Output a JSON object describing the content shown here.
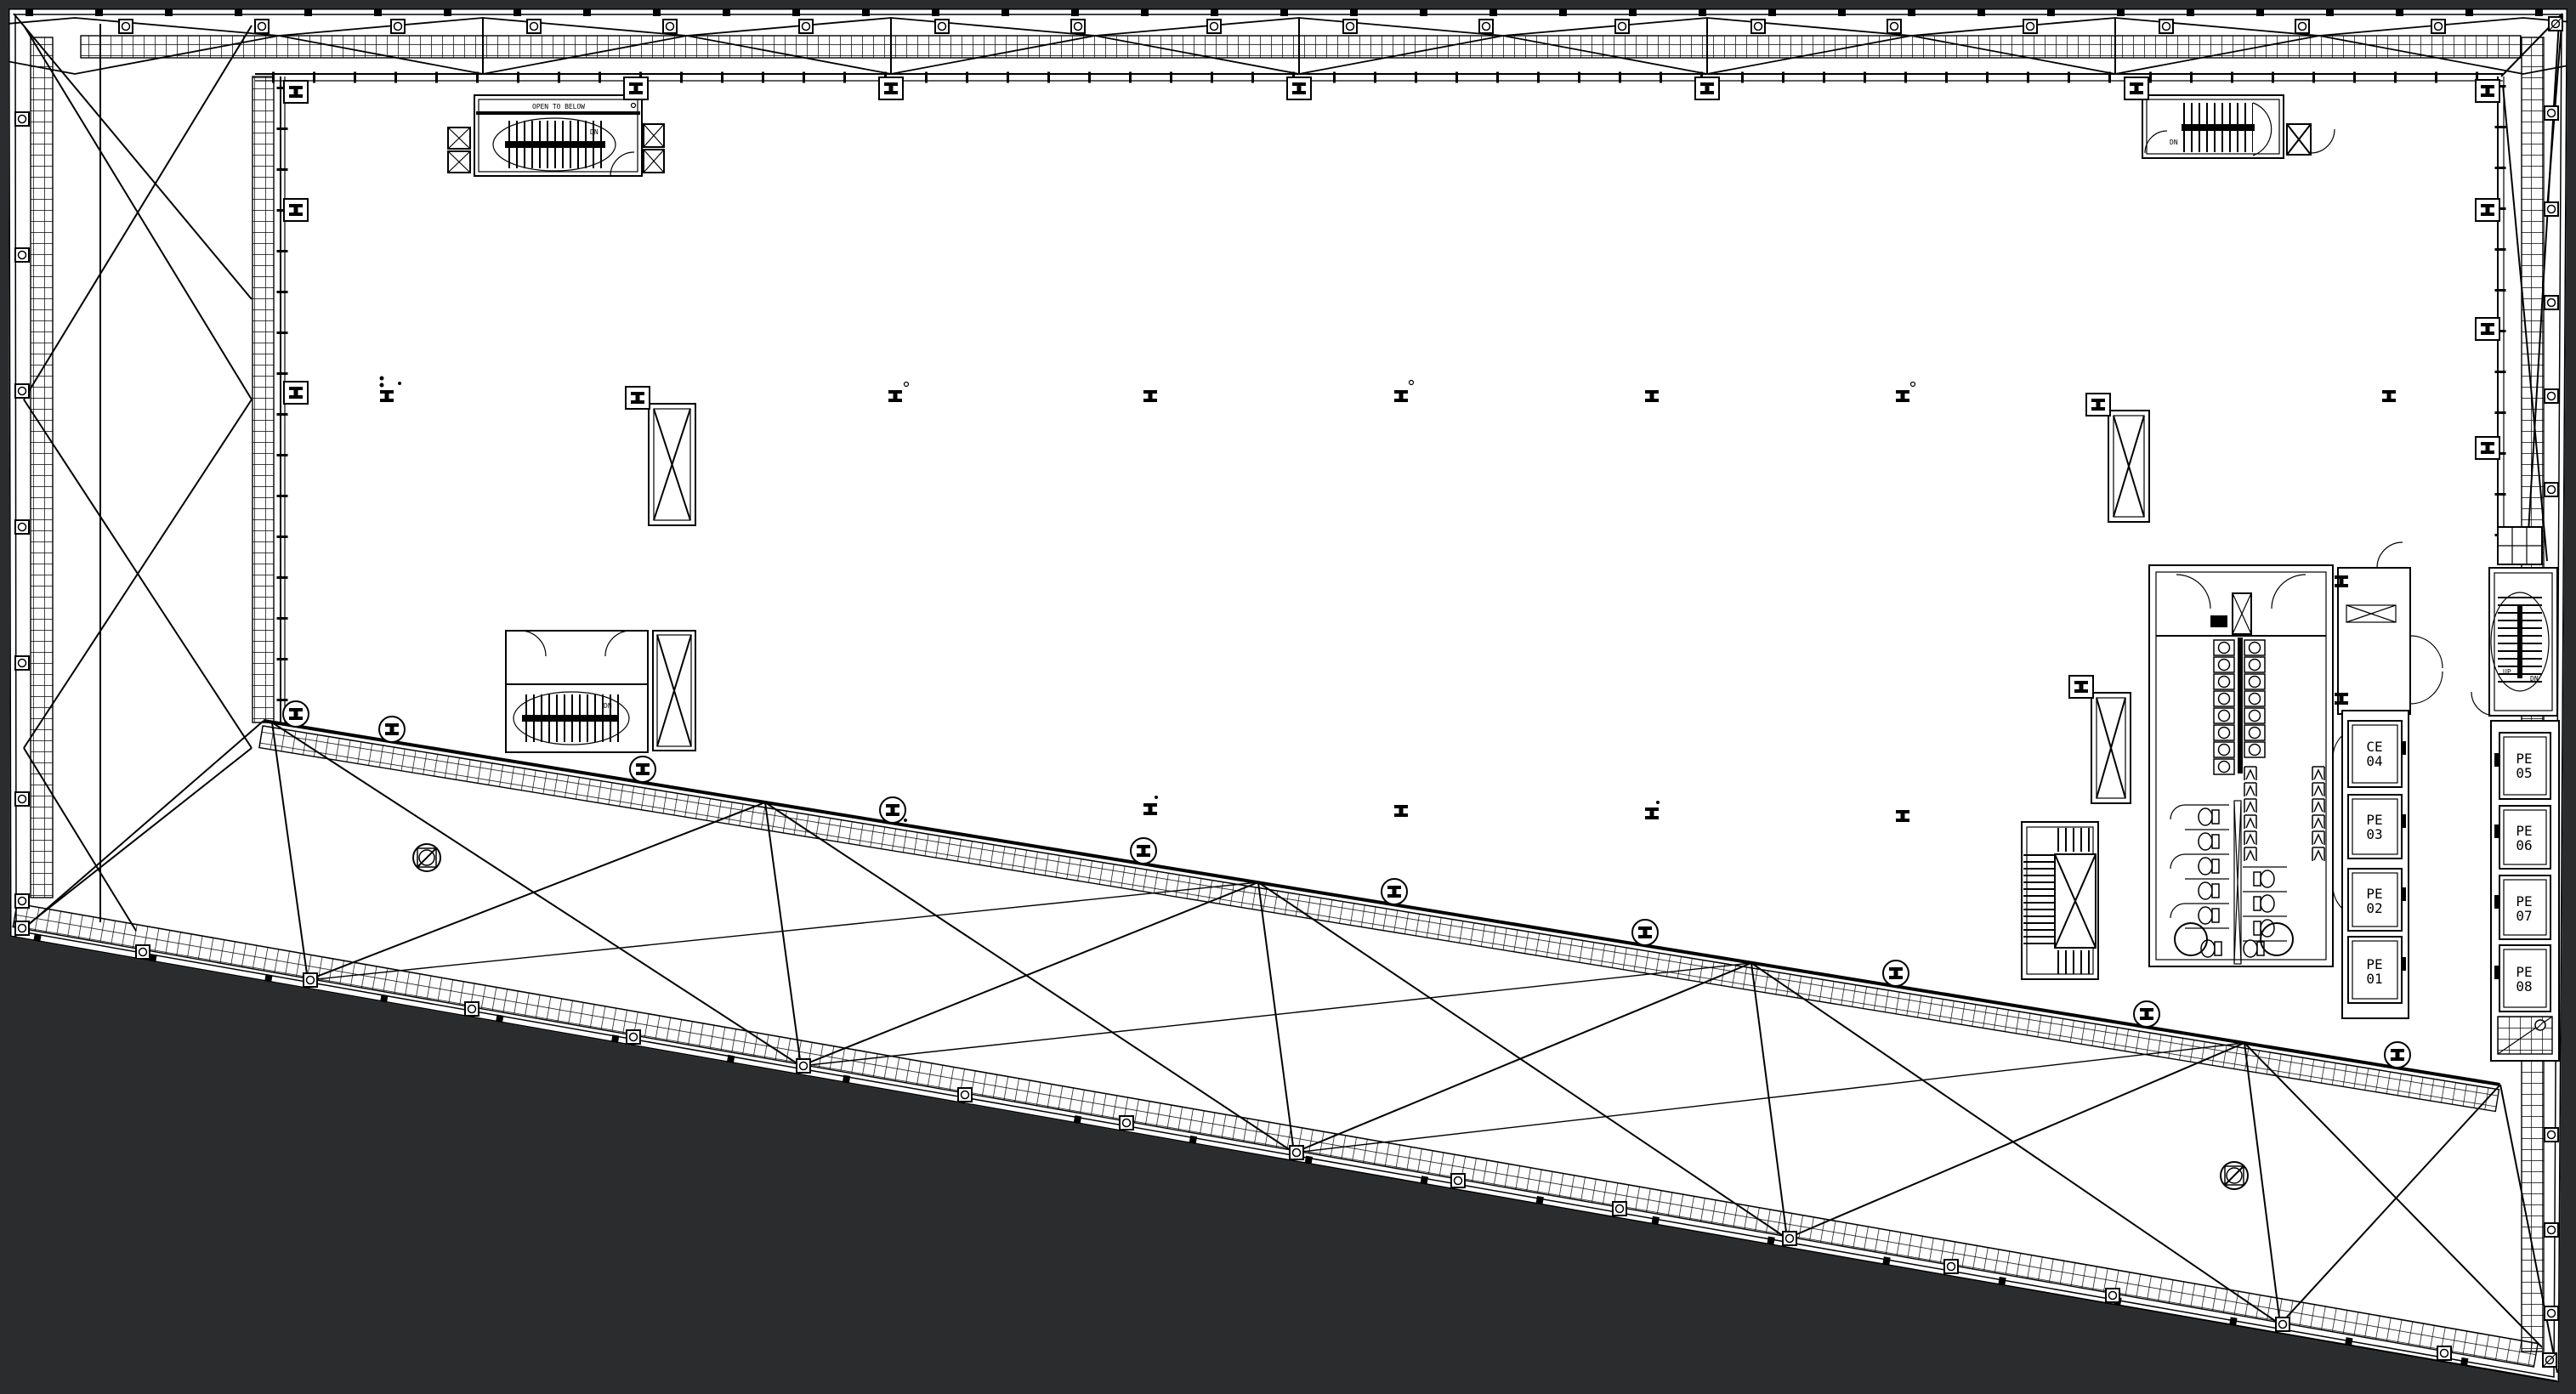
{
  "colors": {
    "background": "#2a2c2d",
    "paper": "#ffffff",
    "ink": "#000000"
  },
  "annotations": {
    "open_to_below": "OPEN TO BELOW",
    "down": "DN",
    "up": "UP"
  },
  "elevators": {
    "inner_bank": [
      {
        "line1": "CE",
        "line2": "04"
      },
      {
        "line1": "PE",
        "line2": "03"
      },
      {
        "line1": "PE",
        "line2": "02"
      },
      {
        "line1": "PE",
        "line2": "01"
      }
    ],
    "edge_bank": [
      {
        "line1": "PE",
        "line2": "05"
      },
      {
        "line1": "PE",
        "line2": "06"
      },
      {
        "line1": "PE",
        "line2": "07"
      },
      {
        "line1": "PE",
        "line2": "08"
      }
    ]
  }
}
